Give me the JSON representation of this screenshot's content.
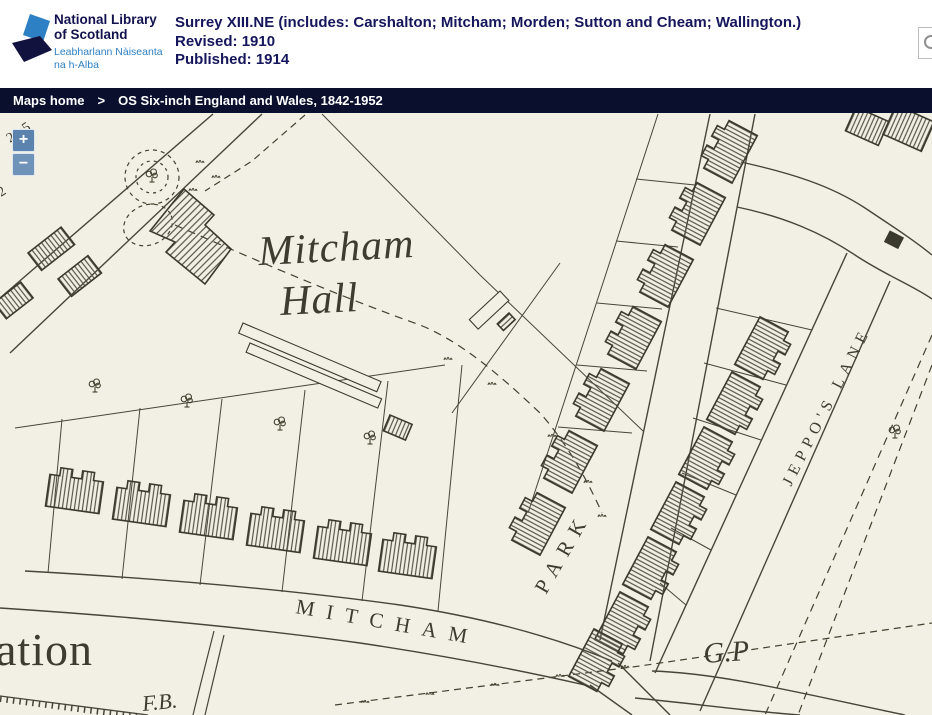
{
  "page": {
    "width": 932,
    "height": 715
  },
  "header": {
    "logo": {
      "org_line1": "National Library",
      "org_line2": "of Scotland",
      "gaelic_line1": "Leabharlann Nàiseanta",
      "gaelic_line2": "na h-Alba"
    },
    "map_title": "Surrey XIII.NE (includes: Carshalton; Mitcham; Morden; Sutton and Cheam; Wallington.)",
    "revised": "Revised: 1910",
    "published": "Published: 1914"
  },
  "breadcrumb": {
    "home": "Maps home",
    "separator": ">",
    "current": "OS Six-inch England and Wales, 1842-1952"
  },
  "controls": {
    "zoom_in": "+",
    "zoom_out": "−"
  },
  "map_labels": [
    {
      "id": "mitcham-hall-1",
      "text": "Mitcham",
      "x": 337,
      "y": 148,
      "size": 42,
      "style": "italic",
      "rot": -3,
      "anchor": "middle",
      "ls": 1
    },
    {
      "id": "mitcham-hall-2",
      "text": "Hall",
      "x": 320,
      "y": 200,
      "size": 42,
      "style": "italic",
      "rot": -3,
      "anchor": "middle",
      "ls": 1
    },
    {
      "id": "road-mitcham",
      "text": "MITCHAM",
      "x": 295,
      "y": 500,
      "size": 21,
      "rot": 10,
      "ls": 12
    },
    {
      "id": "road-park",
      "text": "PARK",
      "x": 546,
      "y": 482,
      "size": 21,
      "rot": -60,
      "ls": 9
    },
    {
      "id": "jeppos-lane",
      "text": "JEPPO'S LANE",
      "x": 791,
      "y": 374,
      "size": 16,
      "rot": -63,
      "ls": 6
    },
    {
      "id": "guide-post",
      "text": "G.P",
      "x": 704,
      "y": 550,
      "size": 29,
      "style": "italic",
      "rot": -4
    },
    {
      "id": "foot-bridge",
      "text": "F.B.",
      "x": 143,
      "y": 598,
      "size": 22,
      "style": "italic",
      "rot": -6
    },
    {
      "id": "ation-partial",
      "text": "ation",
      "x": -4,
      "y": 552,
      "size": 46,
      "ls": 1
    },
    {
      "id": "spot-height",
      "text": "29·5",
      "x": 10,
      "y": 30,
      "size": 14,
      "rot": -33
    },
    {
      "id": "spot-height-2",
      "text": "2",
      "x": 1,
      "y": 84,
      "size": 14,
      "rot": -33
    }
  ],
  "colors": {
    "navy_text": "#16165c",
    "logo_blue": "#2e80c4",
    "logo_dark": "#12123f",
    "breadcrumb_bg": "#0a0f2e",
    "zoom_button": "#5b83ad",
    "map_paper": "#f2efe4",
    "map_ink": "#47453a"
  }
}
